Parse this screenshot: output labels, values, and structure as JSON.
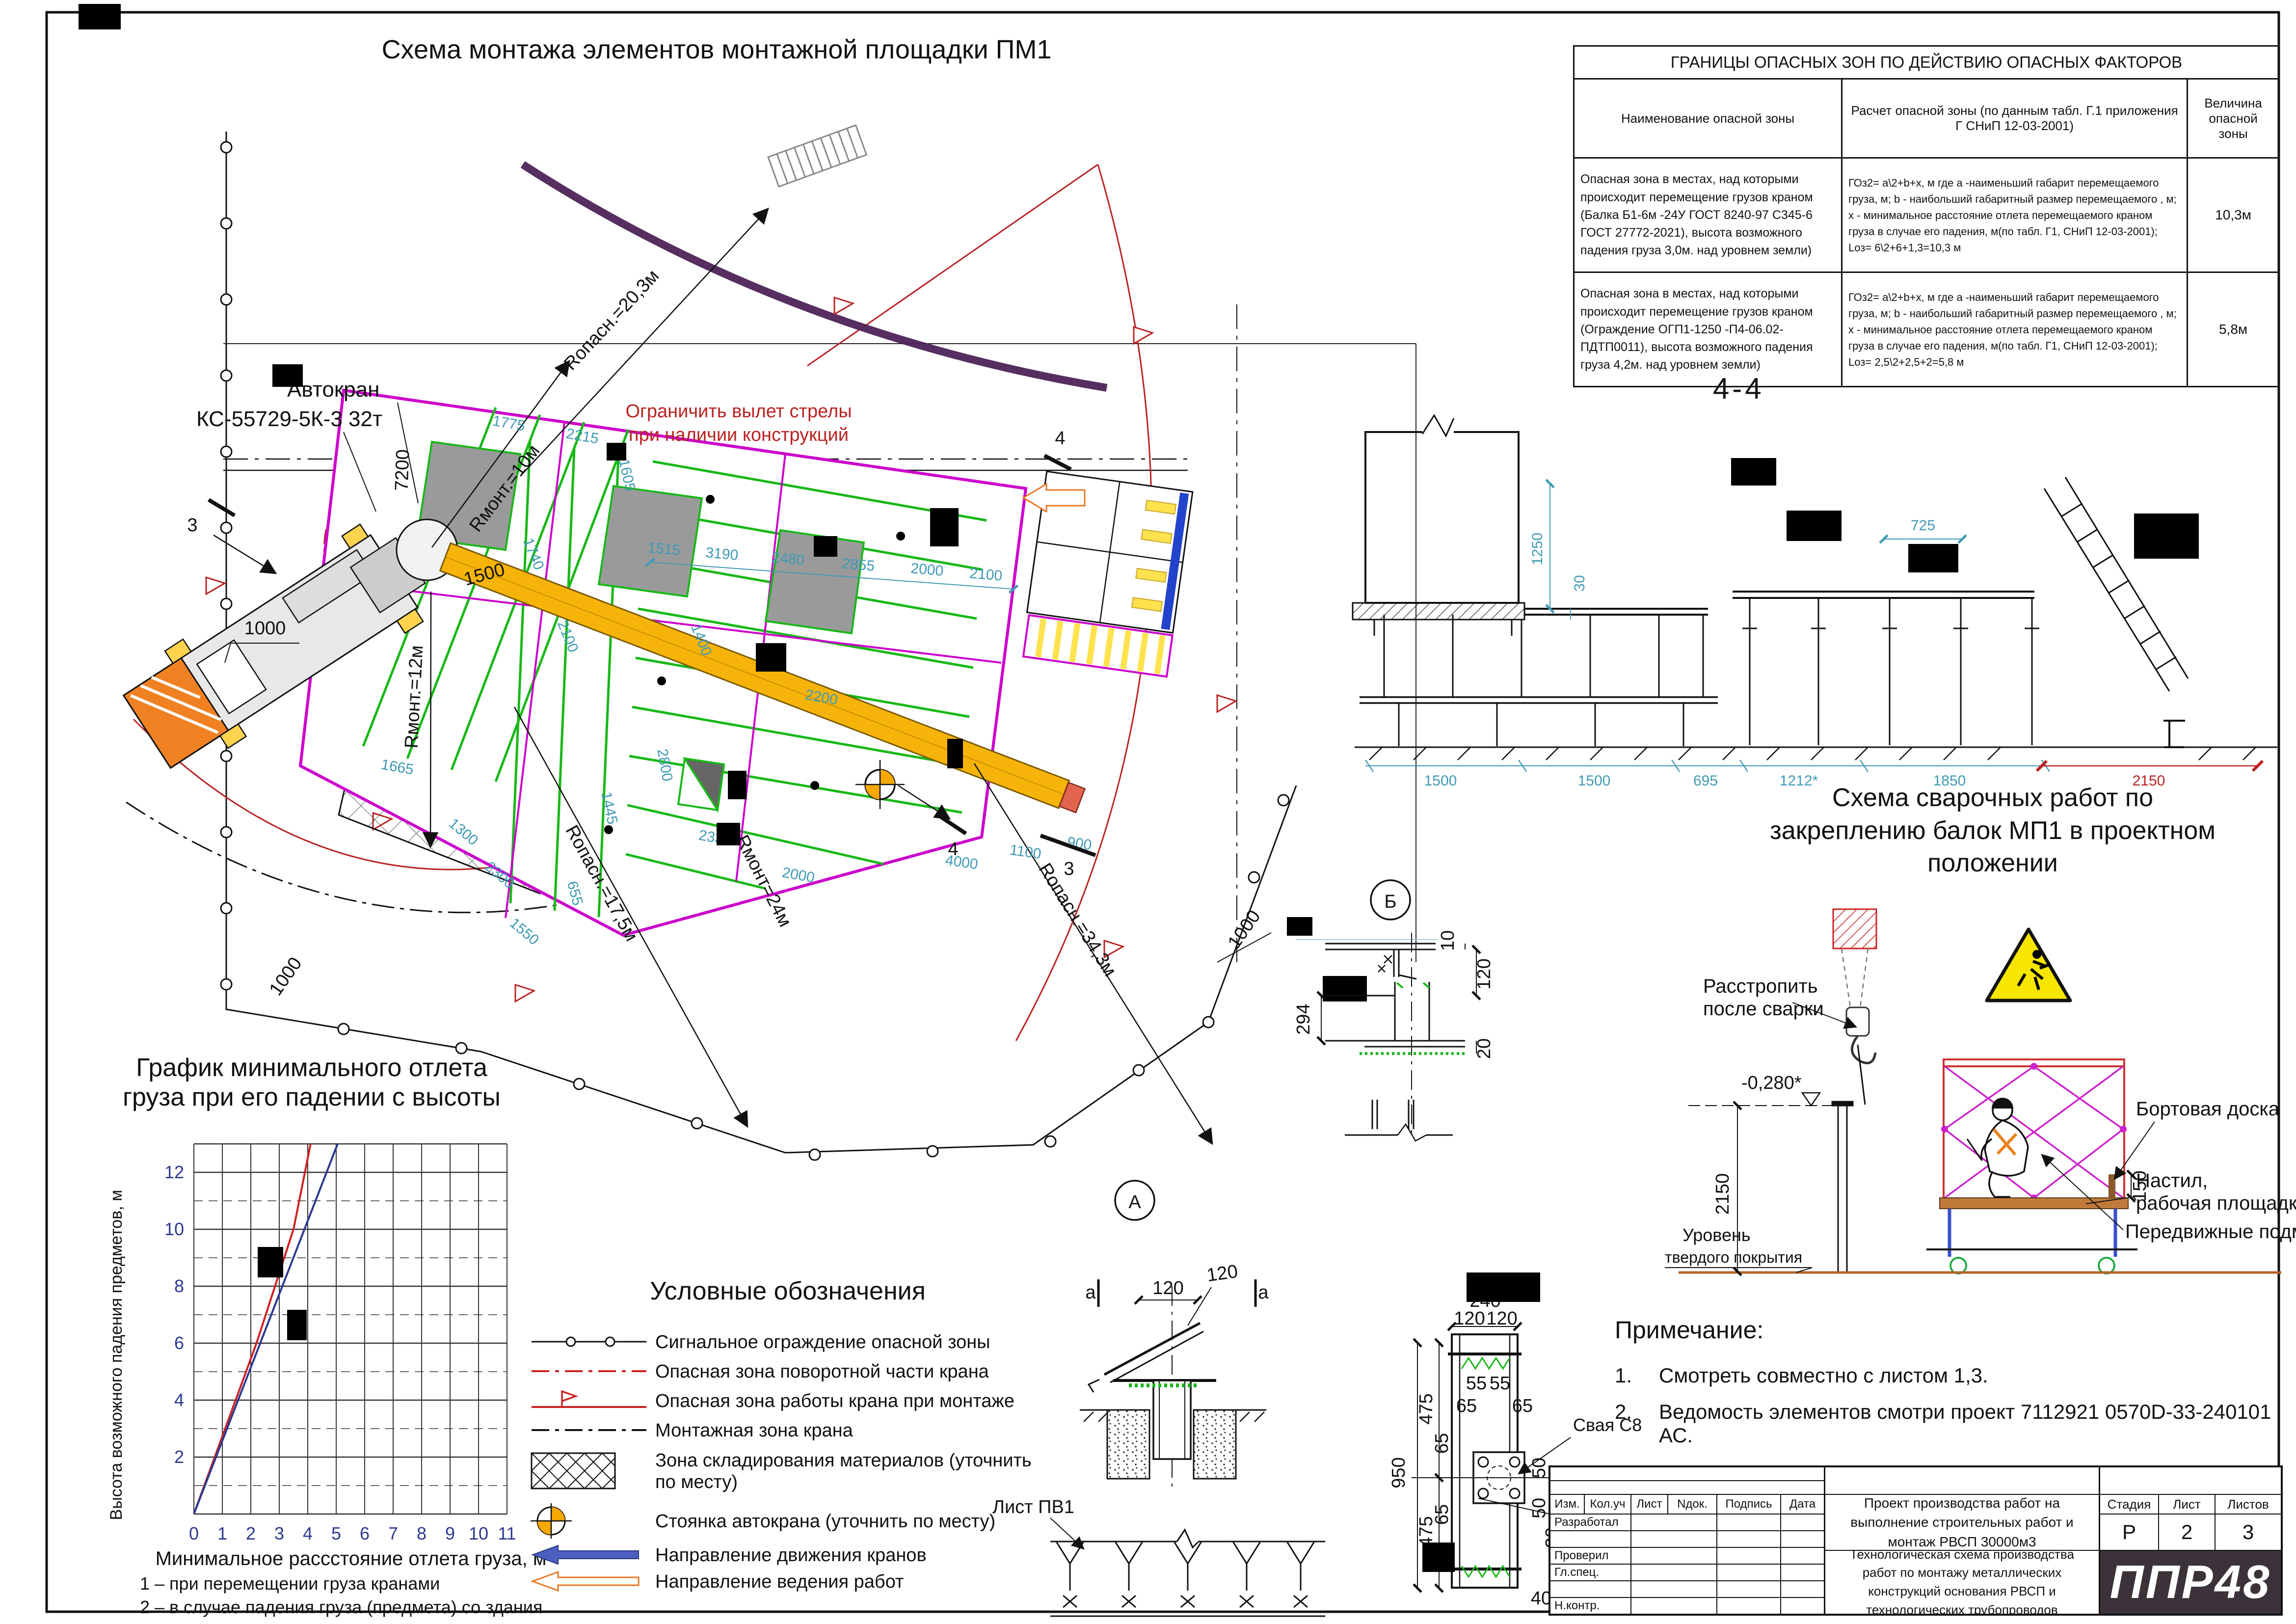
{
  "plan": {
    "title": "Схема монтажа элементов монтажной площадки ПМ1",
    "crane_line1": "Автокран",
    "crane_line2": "КС-55729-5К-3 32т",
    "limit_line1": "Ограничить вылет стрелы",
    "limit_line2": "при наличии конструкций",
    "r_opasn_20": "Rопасн.=20,3м",
    "r_opasn_17": "Rопасн.=17,5м",
    "r_opasn_34": "Rопасн.=34,3м",
    "r_mont_10": "Rмонт.=10м",
    "r_mont_12": "Rмонт.=12м",
    "r_mont_24": "Rмонт=24м",
    "dim_7200": "7200",
    "dim_1500": "1500",
    "dim_1000a": "1000",
    "dim_1000b": "1000",
    "dim_1000c": "1000",
    "top_dims": [
      "1515",
      "3190",
      "2480",
      "2855",
      "2000",
      "2100"
    ],
    "edge_dims": [
      "1775",
      "2215",
      "1605"
    ],
    "mid_dims": [
      "2100",
      "1400",
      "2800",
      "2200",
      "1740",
      "2330",
      "2000",
      "1445",
      "1665",
      "4000",
      "1100",
      "900"
    ],
    "bl_dims": [
      "1300",
      "2300",
      "1550",
      "655"
    ],
    "marker_3": "3",
    "marker_4": "4",
    "marker_a": "А",
    "marker_b": "Б"
  },
  "danger_table": {
    "title": "ГРАНИЦЫ ОПАСНЫХ ЗОН ПО ДЕЙСТВИЮ ОПАСНЫХ ФАКТОРОВ",
    "headers": [
      "Наименование опасной зоны",
      "Расчет опасной зоны (по данным табл. Г.1 приложения Г СНиП 12-03-2001)",
      "Величина опасной зоны"
    ],
    "rows": [
      {
        "name": "Опасная зона в местах, над которыми происходит перемещение грузов краном (Балка Б1-6м -24У ГОСТ 8240-97 С345-6 ГОСТ 27772-2021), высота возможного падения груза 3,0м. над уровнем земли)",
        "calc": "ГОз2= а\\2+b+х, м  где а -наименьший габарит перемещаемого груза, м; b - наибольший габаритный размер перемещаемого , м; х - минимальное расстояние отлета перемещаемого краном груза в случае его падения, м(по табл. Г1, СНиП 12-03-2001); Lоз= 6\\2+6+1,3=10,3 м",
        "value": "10,3м"
      },
      {
        "name": "Опасная зона в местах, над которыми происходит перемещение грузов краном (Ограждение ОГП1-1250 -П4-06.02-ПДТП0011),  высота возможного падения груза 4,2м. над уровнем земли)",
        "calc": "ГОз2= а\\2+b+х, м  где а -наименьший габарит перемещаемого груза, м; b - наибольший габаритный размер перемещаемого , м; х - минимальное расстояние отлета перемещаемого краном груза в случае его падения, м(по табл. Г1, СНиП 12-03-2001); Lоз= 2,5\\2+2,5+2=5,8 м",
        "value": "5,8м"
      }
    ]
  },
  "section44": {
    "title": "4-4",
    "dim_1250": "1250",
    "dim_30": "30",
    "dim_725": "725",
    "bottom_dims": [
      "1500",
      "1500",
      "695",
      "1212*",
      "1850"
    ],
    "dim_2150": "2150"
  },
  "welding": {
    "title1": "Схема сварочных работ по",
    "title2": "закреплению балок МП1 в проектном",
    "title3": "положении",
    "unsling1": "Расстропить",
    "unsling2": "после сварки",
    "level": "-0,280*",
    "dim_2150": "2150",
    "dim_150": "150",
    "board": "Бортовая доска",
    "deck1": "Настил,",
    "deck2": "рабочая площадка",
    "scaffold": "Передвижные подмости",
    "ground1": "Уровень",
    "ground2": "твердого покрытия"
  },
  "chart": {
    "title1": "График минимального отлета",
    "title2": "груза при его падении с высоты",
    "ylabel": "Высота возможного падения предметов, м",
    "xlabel": "Минимальное рассстояние отлета груза, м",
    "x_ticks": [
      "0",
      "1",
      "2",
      "3",
      "4",
      "5",
      "6",
      "7",
      "8",
      "9",
      "10",
      "11"
    ],
    "y_ticks": [
      "2",
      "4",
      "6",
      "8",
      "10",
      "12"
    ],
    "note1": "1 – при перемещении груза кранами",
    "note2": "2 – в случае падения груза (предмета) со здания",
    "chart_data": {
      "type": "line",
      "title": "График минимального отлета груза при его падении с высоты",
      "xlabel": "Минимальное рассстояние отлета груза, м",
      "ylabel": "Высота возможного падения предметов, м",
      "xlim": [
        0,
        11
      ],
      "ylim": [
        0,
        13
      ],
      "grid": true,
      "series": [
        {
          "name": "1 – при перемещении груза кранами",
          "color": "#cc2222",
          "points": [
            [
              0,
              0
            ],
            [
              2.2,
              6
            ],
            [
              3.5,
              10
            ],
            [
              3.7,
              11
            ],
            [
              4.1,
              13
            ]
          ]
        },
        {
          "name": "2 – в случае падения груза (предмета) со здания",
          "color": "#2b3990",
          "points": [
            [
              0,
              0
            ],
            [
              5.05,
              13
            ]
          ]
        }
      ]
    }
  },
  "legend": {
    "title": "Условные обозначения",
    "items": [
      {
        "label": "Сигнальное ограждение опасной зоны"
      },
      {
        "label": "Опасная зона поворотной части крана"
      },
      {
        "label": "Опасная зона работы крана при монтаже"
      },
      {
        "label": "Монтажная зона крана"
      },
      {
        "label": "Зона складирования материалов (уточнить по месту)"
      },
      {
        "label": "Стоянка автокрана (уточнить по месту)"
      },
      {
        "label": "Направление движения кранов"
      },
      {
        "label": "Направление ведения работ"
      }
    ]
  },
  "details": {
    "marker_a_note": "а",
    "dim_120": "120",
    "dim_120b": "120",
    "list_pv1": "Лист ПВ1",
    "b_dim_10": "10",
    "b_dim_120": "120",
    "b_dim_294": "294",
    "b_dim_20": "20",
    "p_dim_240": "240",
    "p_dim_120l": "120",
    "p_dim_120r": "120",
    "p_dim_55a": "55",
    "p_dim_55b": "55",
    "p_dim_65a": "65",
    "p_dim_65b": "65",
    "p_dim_65c": "65",
    "p_dim_65d": "65",
    "p_dim_950": "950",
    "p_dim_475a": "475",
    "p_dim_475b": "475",
    "p_dim_50a": "50",
    "p_dim_50b": "50",
    "p_dim_30": "30",
    "p_dim_40": "40",
    "pile_label": "Свая С8",
    "hole_note1": "Отв. 50х30",
    "hole_note2": "вырезать по месту"
  },
  "notes": {
    "title": "Примечание:",
    "n1num": "1.",
    "n1": "Смотреть совместно с листом 1,3.",
    "n2num": "2.",
    "n2": "Ведомость элементов смотри проект 7112921  0570D-33-240101 АС."
  },
  "titleblock": {
    "cols": [
      "Изм.",
      "Кол.уч",
      "Лист",
      "Nдок.",
      "Подпись",
      "Дата"
    ],
    "row_developed": "Разработал",
    "row_checked": "Проверил",
    "row_chief": "Гл.спец.",
    "row_ncontrol": "Н.контр.",
    "project": "Проект производства работ на выполнение строительных работ и монтаж РВСП 30000м3",
    "doc_title": "Технологическая схема производства работ по монтажу металлических конструкций основания РВСП и технологических трубопроводов",
    "stage_label": "Стадия",
    "sheet_label": "Лист",
    "sheets_label": "Листов",
    "stage": "Р",
    "sheet": "2",
    "sheets": "3",
    "logo": "ППР48"
  }
}
